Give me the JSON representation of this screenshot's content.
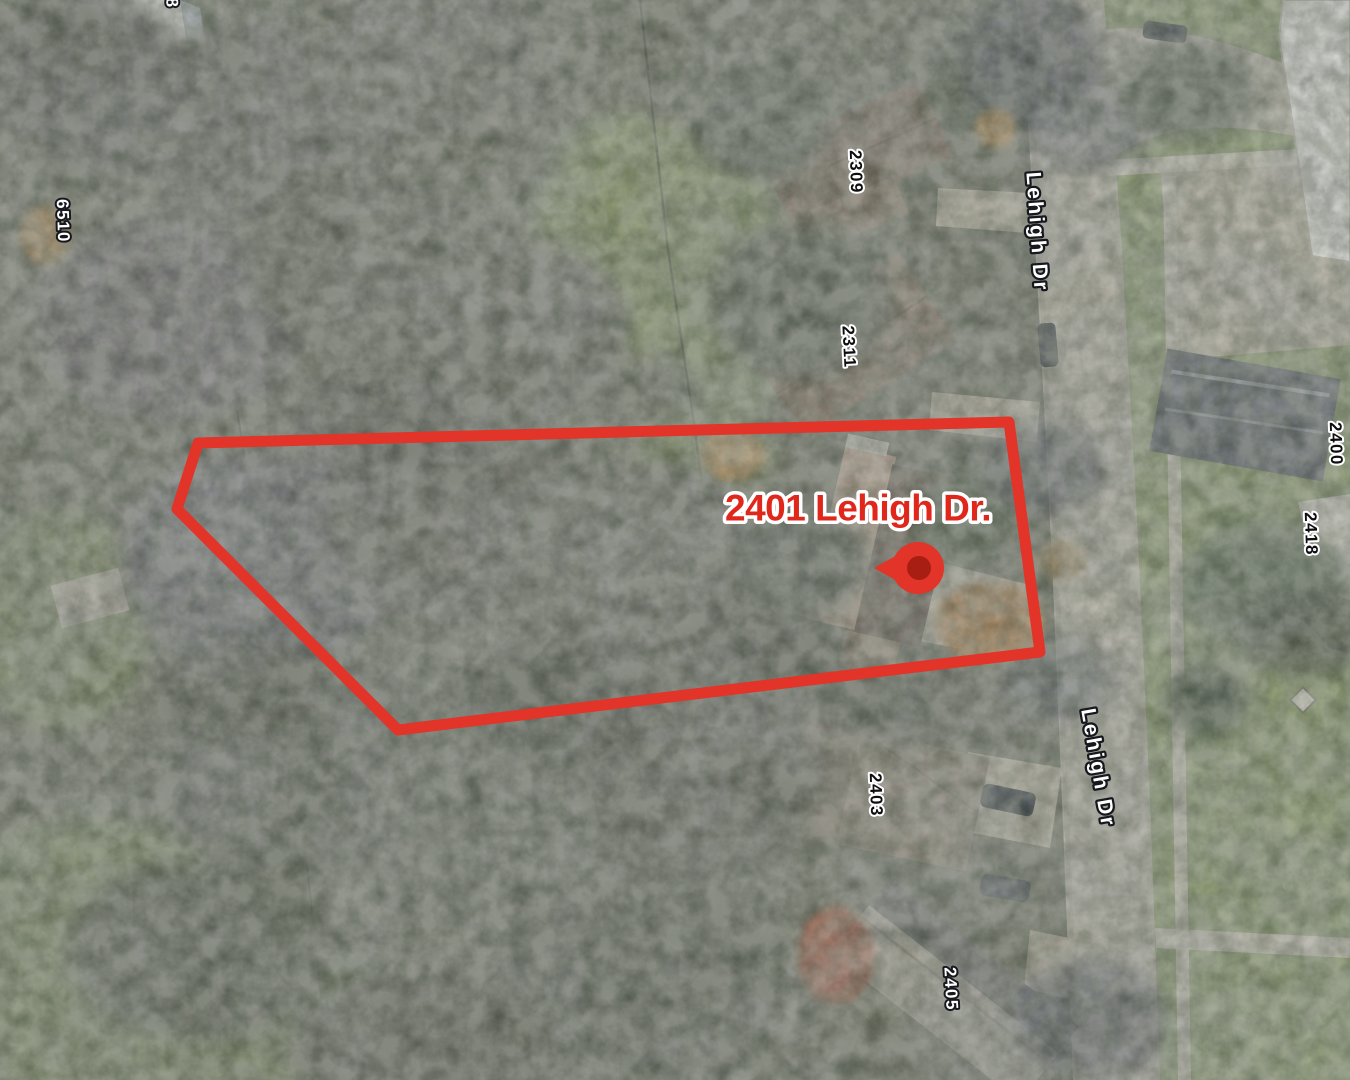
{
  "map": {
    "kind": "satellite-aerial-view",
    "annotation": {
      "color": "#e23428",
      "label_color": "#e0271c",
      "pin_inner_color": "#a81e12",
      "property_label": "2401 Lehigh Dr.",
      "parcel_outline_points": "198,443 1009,422 1040,652 398,730 177,509"
    },
    "streets": {
      "name_top": "Lehigh Dr",
      "name_mid": "Lehigh Dr"
    },
    "addresses": {
      "a6508_partial": "8",
      "a6510": "6510",
      "a2309": "2309",
      "a2311": "2311",
      "a2400": "2400",
      "a2418": "2418",
      "a2403": "2403",
      "a2405": "2405"
    }
  }
}
